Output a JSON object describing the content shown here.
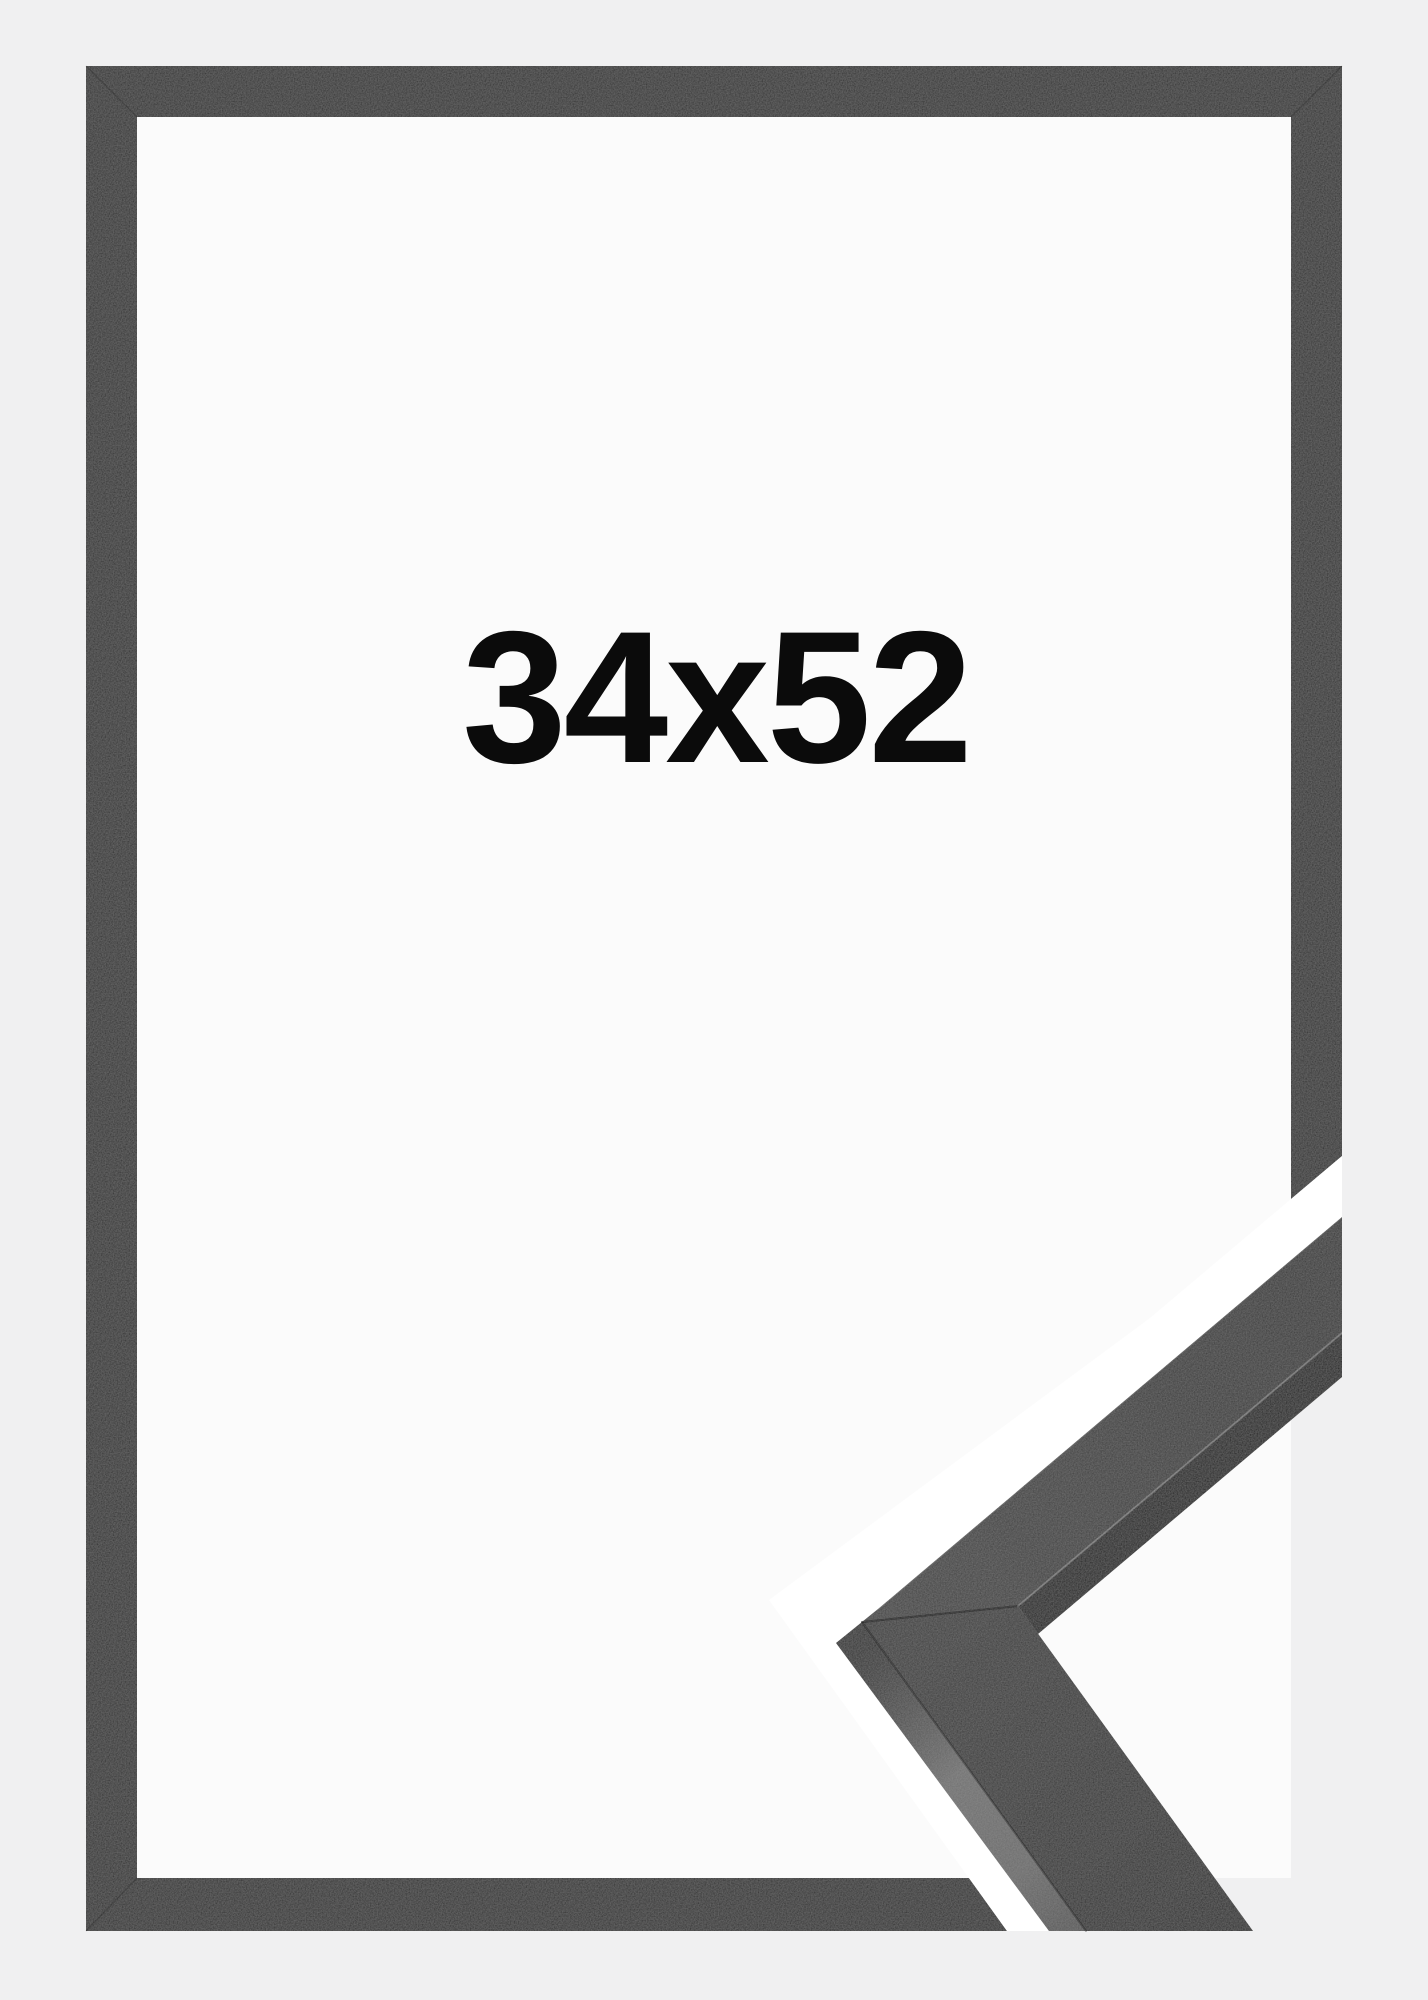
{
  "frame_product": {
    "size_label": "34x52",
    "colors": {
      "page_background": "#f0f0f1",
      "paper": "#fbfbfb",
      "frame": "#2e2e2e",
      "cut_gap": "#ffffff",
      "detail_face_upper": "#3c3c3c",
      "detail_face_lower": "#323232",
      "detail_side_light": "#6d6d6d",
      "detail_side_dark": "#1d1d1d",
      "label_text": "#0b0b0b"
    }
  }
}
